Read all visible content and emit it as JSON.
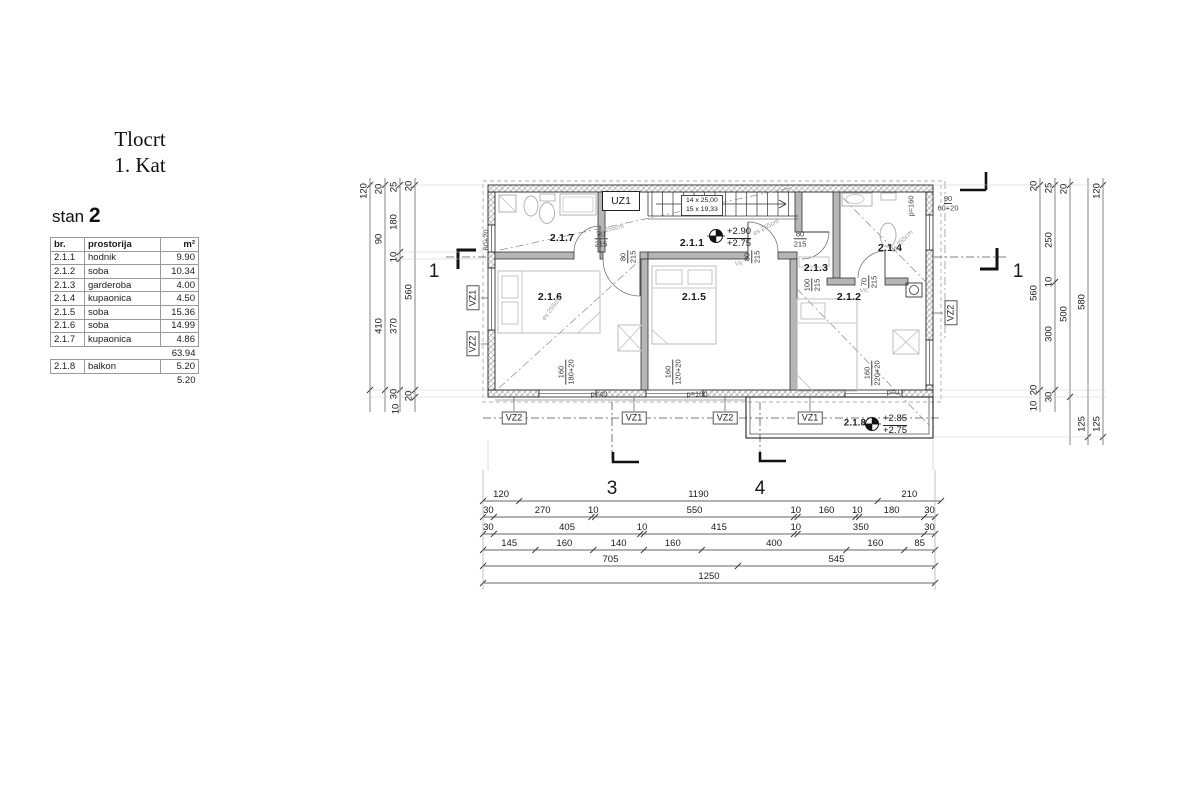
{
  "title": {
    "line1": "Tlocrt",
    "line2": "1. Kat"
  },
  "unit": {
    "label": "stan ",
    "number": "2"
  },
  "table": {
    "headers": {
      "br": "br.",
      "name": "prostorija",
      "area": "m²"
    },
    "rows": [
      {
        "br": "2.1.1",
        "name": "hodnik",
        "area": "9.90"
      },
      {
        "br": "2.1.2",
        "name": "soba",
        "area": "10.34"
      },
      {
        "br": "2.1.3",
        "name": "garderoba",
        "area": "4.00"
      },
      {
        "br": "2.1.4",
        "name": "kupaonica",
        "area": "4.50"
      },
      {
        "br": "2.1.5",
        "name": "soba",
        "area": "15.36"
      },
      {
        "br": "2.1.6",
        "name": "soba",
        "area": "14.99"
      },
      {
        "br": "2.1.7",
        "name": "kupaonica",
        "area": "4.86"
      }
    ],
    "subtotal": "63.94",
    "balcony": {
      "br": "2.1.8",
      "name": "balkon",
      "area": "5.20"
    },
    "balcony_total": "5.20"
  },
  "rooms": {
    "r217": "2.1.7",
    "r211": "2.1.1",
    "r214": "2.1.4",
    "r213": "2.1.3",
    "r216": "2.1.6",
    "r215": "2.1.5",
    "r212": "2.1.2",
    "r218": "2.1.8"
  },
  "stairs": {
    "box": "UZ1",
    "line1": "14 x 25,00",
    "line2": "15 x 19,33"
  },
  "elevations": {
    "main": {
      "top": "+2.90",
      "bot": "+2.75"
    },
    "balcony": {
      "top": "+2.85",
      "bot": "+2.75"
    }
  },
  "doors": [
    {
      "w": "70",
      "h": "215"
    },
    {
      "w": "80",
      "h": "215"
    },
    {
      "w": "80",
      "h": "215"
    },
    {
      "w": "80",
      "h": "215"
    },
    {
      "w": "100",
      "h": "215"
    },
    {
      "w": "70",
      "h": "215"
    }
  ],
  "windows": [
    {
      "w": "160",
      "h": "180+20",
      "sill": "p=40"
    },
    {
      "w": "160",
      "h": "120+20",
      "sill": "p=100"
    },
    {
      "w": "160",
      "h": "220+20",
      "sill": "p=0"
    }
  ],
  "wall_windows": {
    "left": "60+20",
    "right_top": "90",
    "right_top2": "60+20",
    "right_p": "p=160"
  },
  "vk": "VK",
  "vz": {
    "b0": "VZ2",
    "b1": "VZ1",
    "b2": "VZ2",
    "b3": "VZ1",
    "l0": "VZ1",
    "l1": "VZ2",
    "r0": "VZ2"
  },
  "sections": {
    "left": "1",
    "right": "1",
    "three": "3",
    "four": "4"
  },
  "slope": "es 255cm",
  "dims": {
    "bottom_rows": [
      [
        "120",
        "1190",
        "210"
      ],
      [
        "30",
        "270",
        "10",
        "550",
        "10",
        "160",
        "10",
        "180",
        "30"
      ],
      [
        "30",
        "405",
        "10",
        "415",
        "10",
        "350",
        "30"
      ],
      [
        "145",
        "160",
        "140",
        "160",
        "400",
        "160",
        "85"
      ],
      [
        "705",
        "545"
      ],
      [
        "1250"
      ]
    ],
    "left_labels": [
      "120",
      "20",
      "90",
      "410",
      "25",
      "180",
      "10",
      "370",
      "30",
      "10",
      "20",
      "560",
      "20"
    ],
    "right_labels": [
      "20",
      "560",
      "20",
      "10",
      "25",
      "250",
      "10",
      "300",
      "30",
      "20",
      "500",
      "580",
      "125",
      "120",
      "125"
    ]
  }
}
